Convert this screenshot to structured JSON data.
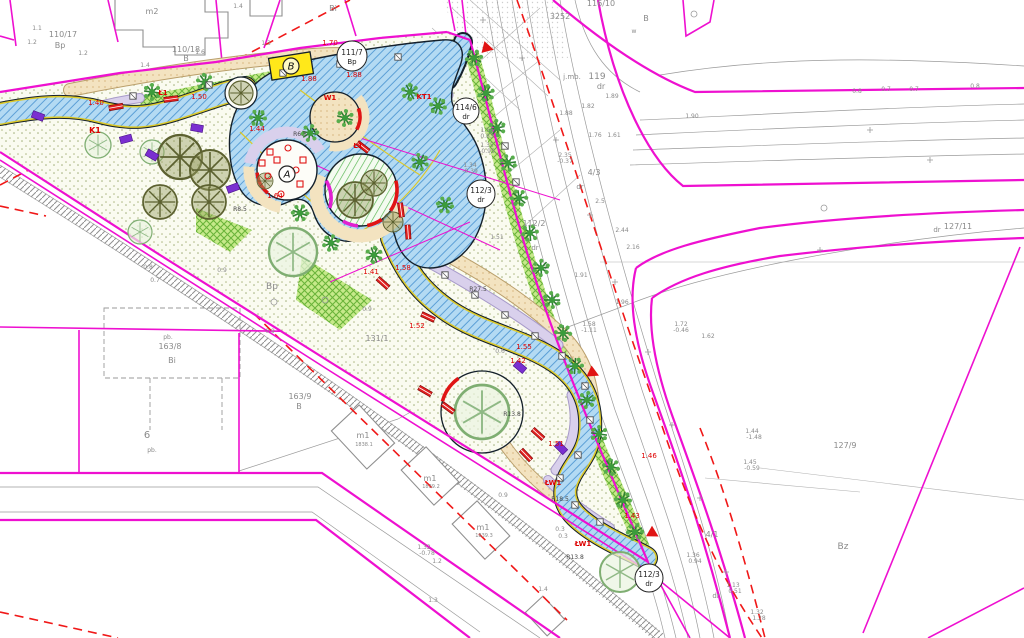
{
  "title": "Cadastral site plan with park path design",
  "colors": {
    "magenta": "#ee10d0",
    "red": "#e01414",
    "dash_red": "#f01818",
    "blue_path": "#b3daf3",
    "blue_hatch": "#5b9fd6",
    "grass_bg": "#fafbf0",
    "grass_dot": "#aeb883",
    "green_strip": "#c6e98a",
    "beige": "#f3e3c0",
    "lavender": "#d9d0ec",
    "olive": "#70753f",
    "tree_green": "#3b9b3b",
    "yellow": "#ffe81a",
    "survey_gray": "#9b9b9b",
    "survey_text": "#8a8a8a"
  },
  "map": {
    "labels": [
      [
        "110/17",
        63,
        37,
        8
      ],
      [
        "Bp",
        60,
        48,
        8
      ],
      [
        "m2",
        152,
        14,
        8
      ],
      [
        "110/18",
        186,
        52,
        8
      ],
      [
        "B",
        186,
        61,
        8
      ],
      [
        "Bi",
        333,
        11,
        8
      ],
      [
        "1.4",
        238,
        8,
        6
      ],
      [
        "1.2",
        83,
        55,
        6
      ],
      [
        "1.4",
        145,
        67,
        6
      ],
      [
        "1.6",
        200,
        54,
        6
      ],
      [
        "1.1",
        37,
        30,
        6
      ],
      [
        "1.2",
        32,
        44,
        6
      ],
      [
        "1.3",
        266,
        45,
        6
      ],
      [
        "116/10",
        601,
        6,
        8
      ],
      [
        "3252",
        560,
        19,
        8
      ],
      [
        "B",
        646,
        21,
        8
      ],
      [
        "w",
        634,
        33,
        6
      ],
      [
        "j.mb.",
        572,
        79,
        7
      ],
      [
        "119",
        597,
        79,
        9
      ],
      [
        "dr",
        601,
        89,
        8
      ],
      [
        "0.8",
        857,
        93,
        6
      ],
      [
        "0.7",
        886,
        91,
        6
      ],
      [
        "0.7",
        914,
        91,
        6
      ],
      [
        "0.8",
        975,
        88,
        6
      ],
      [
        "1.89",
        612,
        98,
        6
      ],
      [
        "1.82",
        588,
        108,
        6
      ],
      [
        "1.88",
        566,
        115,
        6
      ],
      [
        "1.90",
        692,
        118,
        6
      ],
      [
        "1.76",
        595,
        137,
        6
      ],
      [
        "1.61",
        614,
        137,
        6
      ],
      [
        "1.56",
        487,
        132,
        6
      ],
      [
        "0.83",
        487,
        138,
        6
      ],
      [
        "1.35",
        487,
        147,
        6
      ],
      [
        "-0.95",
        487,
        153,
        6
      ],
      [
        "1.34",
        470,
        167,
        6
      ],
      [
        "-0.39",
        470,
        173,
        6
      ],
      [
        "2.35",
        565,
        157,
        6
      ],
      [
        "-0.37",
        565,
        163,
        6
      ],
      [
        "2.5",
        600,
        203,
        6
      ],
      [
        "4/3",
        594,
        175,
        8
      ],
      [
        "dr",
        580,
        189,
        7
      ],
      [
        "112/2",
        534,
        226,
        8
      ],
      [
        "dr",
        535,
        250,
        7
      ],
      [
        "1.51",
        497,
        239,
        6
      ],
      [
        "2.44",
        622,
        232,
        6
      ],
      [
        "2.16",
        633,
        249,
        6
      ],
      [
        "1.91",
        581,
        277,
        6
      ],
      [
        "1.96",
        622,
        304,
        6
      ],
      [
        "1.58",
        589,
        326,
        6
      ],
      [
        "-1.11",
        589,
        332,
        6
      ],
      [
        "1.72",
        681,
        326,
        6
      ],
      [
        "-0.46",
        681,
        332,
        6
      ],
      [
        "1.62",
        708,
        338,
        6
      ],
      [
        "127/11",
        958,
        229,
        8
      ],
      [
        "dr",
        937,
        232,
        7
      ],
      [
        "1.44",
        752,
        433,
        6
      ],
      [
        "-1.48",
        754,
        439,
        6
      ],
      [
        "1.45",
        750,
        464,
        6
      ],
      [
        "-0.59",
        752,
        470,
        6
      ],
      [
        "127/9",
        845,
        448,
        8
      ],
      [
        "Bz",
        843,
        549,
        9
      ],
      [
        "4/1",
        712,
        537,
        8
      ],
      [
        "dr",
        716,
        598,
        7
      ],
      [
        "1.36",
        693,
        557,
        6
      ],
      [
        "0.94",
        695,
        563,
        6
      ],
      [
        "1.13",
        733,
        587,
        6
      ],
      [
        "0.51",
        735,
        593,
        6
      ],
      [
        "1.32",
        757,
        614,
        6
      ],
      [
        "1.28",
        759,
        620,
        6
      ],
      [
        "163/8",
        170,
        349,
        8
      ],
      [
        "Bi",
        172,
        363,
        8
      ],
      [
        "pb.",
        168,
        339,
        6
      ],
      [
        "6",
        147,
        438,
        10
      ],
      [
        "pb.",
        152,
        452,
        6
      ],
      [
        "163/9",
        300,
        399,
        8
      ],
      [
        "B",
        299,
        409,
        8
      ],
      [
        "m1",
        363,
        438,
        8
      ],
      [
        "1838.1",
        364,
        446,
        5
      ],
      [
        "m1",
        430,
        481,
        8
      ],
      [
        "1839.2",
        431,
        488,
        5
      ],
      [
        "m1",
        483,
        530,
        8
      ],
      [
        "1839.3",
        484,
        537,
        5
      ],
      [
        "131/1",
        377,
        341,
        8
      ],
      [
        "Bp",
        272,
        289,
        9
      ],
      [
        "0.9",
        367,
        311,
        6
      ],
      [
        "0.8",
        148,
        269,
        6
      ],
      [
        "0.7",
        155,
        282,
        6
      ],
      [
        "0.9",
        222,
        272,
        6
      ],
      [
        "0.9",
        270,
        333,
        6
      ],
      [
        "1.2",
        437,
        563,
        6
      ],
      [
        "1.4",
        543,
        591,
        6
      ],
      [
        "1.3",
        433,
        602,
        6
      ],
      [
        "0.9",
        503,
        497,
        6
      ],
      [
        "0.3",
        560,
        531,
        6
      ],
      [
        "0.3",
        563,
        538,
        6
      ],
      [
        "1.32",
        424,
        549,
        6
      ],
      [
        "-0.78",
        427,
        555,
        6
      ],
      [
        "0.6",
        500,
        353,
        6
      ],
      [
        "K1",
        95,
        133,
        8,
        "#dd0000",
        1
      ],
      [
        "W1",
        330,
        100,
        7,
        "#dd0000",
        1
      ],
      [
        "KT1",
        424,
        99,
        7,
        "#dd0000",
        1
      ],
      [
        "Ł1",
        163,
        95,
        7,
        "#dd0000",
        1
      ],
      [
        "Ł1",
        358,
        148,
        7,
        "#dd0000",
        1
      ],
      [
        "ŁW1",
        553,
        485,
        7,
        "#dd0000",
        1
      ],
      [
        "ŁW1",
        583,
        546,
        7,
        "#dd0000",
        1
      ],
      [
        "1.40",
        96,
        105,
        7,
        "#dd0000"
      ],
      [
        "1.50",
        199,
        99,
        7,
        "#dd0000"
      ],
      [
        "1.70",
        330,
        45,
        7,
        "#dd0000"
      ],
      [
        "1.88",
        309,
        81,
        7,
        "#dd0000"
      ],
      [
        "1.88",
        354,
        77,
        7,
        "#dd0000"
      ],
      [
        "1.44",
        257,
        131,
        7,
        "#dd0000"
      ],
      [
        "1.64",
        275,
        198,
        7,
        "#dd0000"
      ],
      [
        "1.55",
        524,
        349,
        7,
        "#dd0000"
      ],
      [
        "1.42",
        518,
        363,
        7,
        "#dd0000"
      ],
      [
        "1.52",
        417,
        328,
        7,
        "#dd0000"
      ],
      [
        "1.58",
        403,
        270,
        7,
        "#dd0000"
      ],
      [
        "1.41",
        371,
        274,
        7,
        "#dd0000"
      ],
      [
        "1.43",
        632,
        518,
        7,
        "#dd0000"
      ],
      [
        "1.51",
        556,
        446,
        7,
        "#dd0000"
      ],
      [
        "1.46",
        649,
        458,
        7,
        "#dd0000"
      ],
      [
        "R27.5",
        478,
        291,
        6,
        "#444444"
      ],
      [
        "R13.8",
        512,
        416,
        6,
        "#444444"
      ],
      [
        "R18.5",
        560,
        501,
        6,
        "#444444"
      ],
      [
        "R8.5",
        240,
        211,
        6,
        "#444444"
      ],
      [
        "R6.5",
        300,
        136,
        6,
        "#444444"
      ],
      [
        "R13.8",
        575,
        559,
        6,
        "#444444"
      ]
    ],
    "circled_labels": [
      [
        "111/7",
        "Bp",
        352,
        56,
        15
      ],
      [
        "114/6",
        "dr",
        466,
        111,
        13
      ],
      [
        "112/3",
        "dr",
        481,
        194,
        14
      ],
      [
        "112/3",
        "dr",
        649,
        578,
        14
      ]
    ],
    "letters": [
      [
        "A",
        287,
        174
      ],
      [
        "B",
        291,
        66
      ]
    ],
    "triangles": [
      [
        483,
        47,
        14
      ],
      [
        589,
        371,
        25
      ],
      [
        649,
        531,
        30
      ]
    ],
    "trees_olive": [
      [
        180,
        157,
        22
      ],
      [
        210,
        170,
        20
      ],
      [
        160,
        202,
        17
      ],
      [
        209,
        202,
        17
      ],
      [
        265,
        181,
        8
      ],
      [
        241,
        93,
        12
      ],
      [
        355,
        200,
        18
      ],
      [
        374,
        183,
        13
      ],
      [
        393,
        222,
        10
      ]
    ],
    "trees_light": [
      [
        98,
        145,
        13
      ],
      [
        152,
        152,
        12
      ],
      [
        293,
        252,
        24
      ],
      [
        482,
        412,
        27
      ],
      [
        620,
        572,
        20
      ],
      [
        140,
        232,
        12
      ]
    ],
    "trees_fluffy": [
      [
        152,
        92
      ],
      [
        205,
        82
      ],
      [
        258,
        118
      ],
      [
        310,
        133
      ],
      [
        345,
        118
      ],
      [
        410,
        92
      ],
      [
        438,
        106
      ],
      [
        300,
        213
      ],
      [
        331,
        243
      ],
      [
        374,
        255
      ],
      [
        420,
        162
      ],
      [
        445,
        205
      ],
      [
        474,
        58
      ],
      [
        486,
        93
      ],
      [
        497,
        128
      ],
      [
        508,
        163
      ],
      [
        519,
        198
      ],
      [
        530,
        233
      ],
      [
        541,
        268
      ],
      [
        552,
        300
      ],
      [
        563,
        333
      ],
      [
        575,
        366
      ],
      [
        587,
        400
      ],
      [
        599,
        434
      ],
      [
        611,
        467
      ],
      [
        623,
        500
      ],
      [
        635,
        532
      ]
    ],
    "benches": [
      [
        116,
        107,
        -10
      ],
      [
        171,
        99,
        -8
      ],
      [
        363,
        147,
        38
      ],
      [
        401,
        210,
        82
      ],
      [
        408,
        232,
        86
      ],
      [
        383,
        283,
        42
      ],
      [
        428,
        317,
        25
      ],
      [
        425,
        391,
        30
      ],
      [
        448,
        408,
        36
      ],
      [
        538,
        434,
        42
      ],
      [
        526,
        455,
        46
      ]
    ],
    "bins": [
      [
        133,
        96
      ],
      [
        209,
        85
      ],
      [
        283,
        73
      ],
      [
        340,
        64
      ],
      [
        398,
        57
      ],
      [
        445,
        275
      ],
      [
        475,
        295
      ],
      [
        505,
        315
      ],
      [
        535,
        336
      ],
      [
        562,
        356
      ],
      [
        585,
        386
      ],
      [
        590,
        420
      ],
      [
        578,
        455
      ],
      [
        560,
        478
      ],
      [
        575,
        505
      ],
      [
        600,
        522
      ],
      [
        505,
        146
      ],
      [
        516,
        182
      ]
    ],
    "shrubs": [
      [
        38,
        116,
        20
      ],
      [
        126,
        139,
        -15
      ],
      [
        152,
        155,
        30
      ],
      [
        197,
        128,
        10
      ],
      [
        233,
        188,
        -20
      ],
      [
        520,
        367,
        40
      ],
      [
        561,
        448,
        45
      ]
    ],
    "play_items": [
      [
        270,
        152,
        "r"
      ],
      [
        288,
        148,
        "c"
      ],
      [
        303,
        160,
        "r"
      ],
      [
        268,
        176,
        "c"
      ],
      [
        300,
        184,
        "r"
      ],
      [
        281,
        194,
        "c"
      ],
      [
        262,
        163,
        "r"
      ],
      [
        296,
        170,
        "c"
      ],
      [
        277,
        160,
        "r"
      ]
    ],
    "crosses": [
      [
        483,
        20
      ],
      [
        522,
        58
      ],
      [
        556,
        140
      ],
      [
        590,
        215
      ],
      [
        615,
        282
      ],
      [
        648,
        352
      ],
      [
        672,
        425
      ],
      [
        700,
        498
      ],
      [
        726,
        572
      ],
      [
        870,
        130
      ],
      [
        930,
        160
      ],
      [
        820,
        250
      ]
    ],
    "small_circles": [
      [
        274,
        302
      ],
      [
        325,
        300
      ],
      [
        694,
        14
      ],
      [
        824,
        208
      ]
    ]
  }
}
